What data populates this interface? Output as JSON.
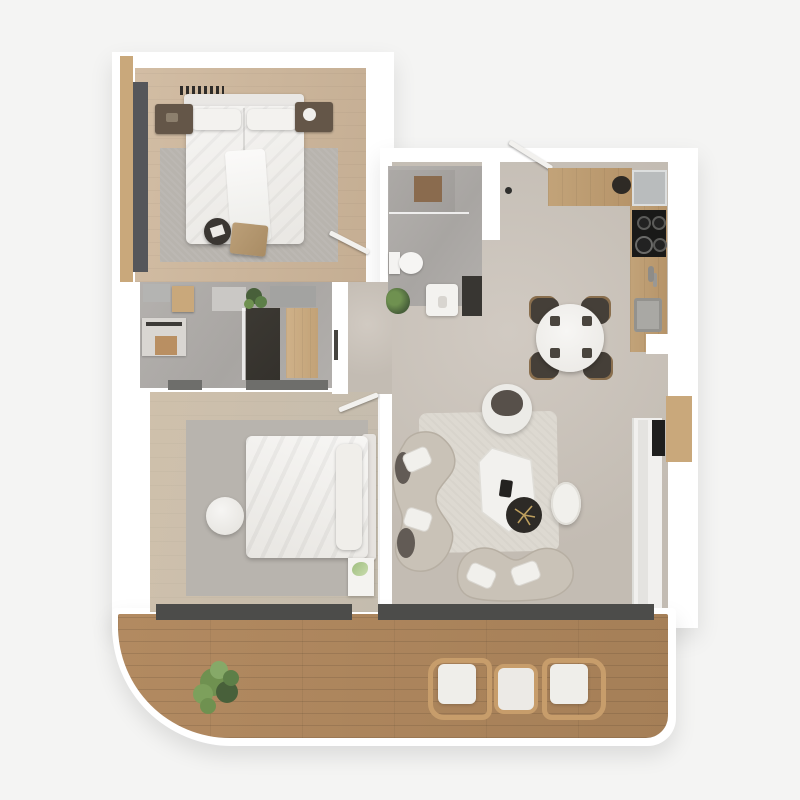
{
  "image": {
    "kind": "3d-floor-plan-top-down-render",
    "description": "Photorealistic top-down 3D floor plan of a two-bedroom apartment with two bathrooms, open kitchen/living/dining area and a large wrap wooden balcony with rounded corner",
    "visible_text": []
  },
  "colors": {
    "background": "#f4f4f3",
    "wall": "#ffffff",
    "wood_floor": "#d2bda4",
    "wood_trim": "#c9a87b",
    "concrete_floor": "#c3bcb3",
    "concrete_light": "#d1cac2",
    "marble_floor": "#b4b1ae",
    "deck_wood": "#b28a61",
    "threshold": "#4c4c4a",
    "counter_wood": "#c2a379",
    "appliance_gray": "#b9bcbd",
    "cooktop_black": "#191918",
    "rug": "#b8b4ae",
    "rug_light": "#ddd9d1",
    "white_furniture": "#f3f2ef",
    "furniture_darkwood": "#645648",
    "sofa": "#c9c2b7",
    "sofa_dark": "#57504a",
    "seat_dark": "#453f38",
    "pouf_dark": "#3a3632",
    "shower_dark": "#34312c",
    "glass_dark": "#383632",
    "plant_green": "#6f9150",
    "plant_dark": "#48603a",
    "lounge_wood": "#c79d6b",
    "wardrobe_gray": "#55565a"
  },
  "rooms": [
    {
      "id": "master-bedroom",
      "label": "Master Bedroom",
      "floor": "wood",
      "furniture": [
        "double-bed",
        "headboard-shelf",
        "pillows",
        "nightstand-left",
        "nightstand-right",
        "area-rug",
        "tall-wardrobe",
        "round-pouf",
        "foot-bench"
      ]
    },
    {
      "id": "ensuite-bathroom",
      "label": "En-suite Bathroom",
      "floor": "marble",
      "furniture": [
        "vanity",
        "towel-rail",
        "wood-stool",
        "shower-dark-marble",
        "bath-mats",
        "plant",
        "wood-band"
      ]
    },
    {
      "id": "bathroom",
      "label": "Bathroom",
      "floor": "marble",
      "furniture": [
        "walk-in-shower",
        "brown-bath-mat",
        "toilet",
        "vanity-sink",
        "plant",
        "glass-panel"
      ]
    },
    {
      "id": "kitchen",
      "label": "Kitchen",
      "floor": "concrete",
      "furniture": [
        "top-counter",
        "serving-bowl",
        "fridge",
        "cooktop-4-burners",
        "faucet",
        "sink",
        "base-cabinet"
      ]
    },
    {
      "id": "dining",
      "label": "Dining Area",
      "floor": "concrete",
      "furniture": [
        "round-table",
        "place-settings",
        "chair-nw",
        "chair-ne",
        "chair-sw",
        "chair-se"
      ]
    },
    {
      "id": "living-room",
      "label": "Living Room",
      "floor": "concrete",
      "furniture": [
        "curved-sofa-left",
        "curved-sofa-bottom",
        "throw-pillows",
        "round-armchair",
        "organic-coffee-table",
        "remote",
        "dark-side-table",
        "plant-sprig",
        "oval-pouf",
        "light-rug",
        "window-band"
      ]
    },
    {
      "id": "bedroom-2",
      "label": "Bedroom 2",
      "floor": "wood",
      "furniture": [
        "double-bed",
        "headboard",
        "area-rug",
        "round-pouf",
        "magazine-stack",
        "closet-strips",
        "window-band"
      ]
    },
    {
      "id": "hallway",
      "label": "Hallway",
      "floor": "concrete",
      "furniture": [
        "entry-door",
        "bedroom-doors"
      ]
    },
    {
      "id": "balcony",
      "label": "Balcony",
      "floor": "deck",
      "furniture": [
        "potted-plant",
        "lounge-chair-left",
        "side-table",
        "lounge-chair-right"
      ]
    }
  ]
}
